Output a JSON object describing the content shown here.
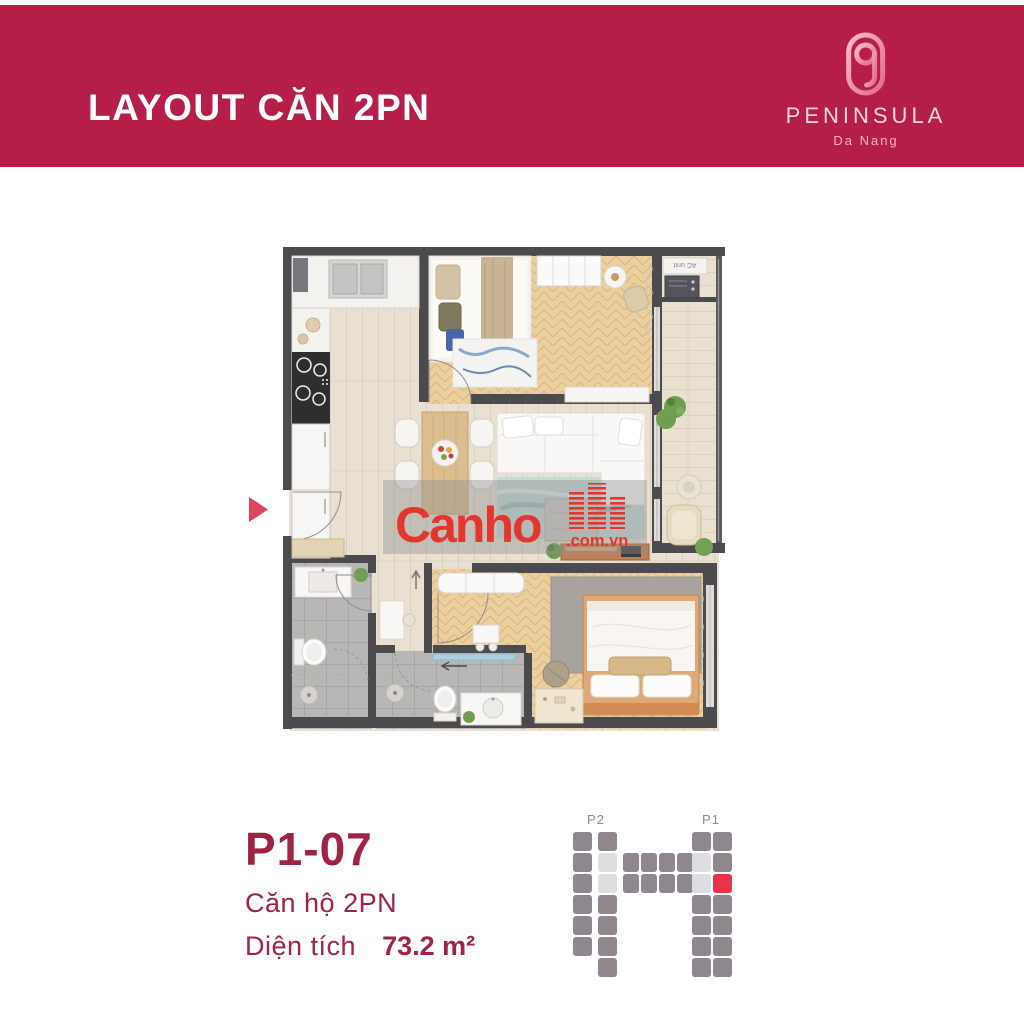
{
  "banner": {
    "title": "LAYOUT CĂN 2PN",
    "brand": "PENINSULA",
    "brand_sub": "Da Nang",
    "bg_color": "#B51F47"
  },
  "unit_info": {
    "code": "P1-07",
    "type_label": "Căn hộ 2PN",
    "area_label": "Diện tích",
    "area_value": "73.2 m²",
    "text_color": "#A02343"
  },
  "watermark": {
    "name": "Canho",
    "domain": ".com.vn",
    "color": "#E3372E"
  },
  "floorplan": {
    "ac_unit_label": "AC unit",
    "wall_color": "#4B4A4C",
    "entry_marker_color": "#DC4560",
    "floor_wood_color": "#E9E0D2",
    "floor_herringbone_color": "#ECCF9F",
    "floor_tile_color": "#B8B7B5"
  },
  "site_diagram": {
    "labels": [
      {
        "text": "P2",
        "x": 23
      },
      {
        "text": "P1",
        "x": 138
      }
    ],
    "colors": {
      "block": "#8E888E",
      "corridor": "#DEDDE0",
      "highlight": "#E83348",
      "label": "#8E888E"
    },
    "unit": {
      "w": 19,
      "h": 19
    },
    "blocks": [
      {
        "x": 0,
        "y": 24,
        "c": "g"
      },
      {
        "x": 0,
        "y": 45,
        "c": "g"
      },
      {
        "x": 0,
        "y": 66,
        "c": "g"
      },
      {
        "x": 0,
        "y": 87,
        "c": "g"
      },
      {
        "x": 0,
        "y": 108,
        "c": "g"
      },
      {
        "x": 0,
        "y": 129,
        "c": "g"
      },
      {
        "x": 25,
        "y": 24,
        "c": "g"
      },
      {
        "x": 25,
        "y": 45,
        "c": "l"
      },
      {
        "x": 25,
        "y": 66,
        "c": "l"
      },
      {
        "x": 25,
        "y": 87,
        "c": "g"
      },
      {
        "x": 25,
        "y": 108,
        "c": "g"
      },
      {
        "x": 25,
        "y": 129,
        "c": "g"
      },
      {
        "x": 25,
        "y": 150,
        "c": "g"
      },
      {
        "x": 50,
        "y": 45,
        "c": "g",
        "w": 16
      },
      {
        "x": 68,
        "y": 45,
        "c": "g",
        "w": 16
      },
      {
        "x": 86,
        "y": 45,
        "c": "g",
        "w": 16
      },
      {
        "x": 104,
        "y": 45,
        "c": "g",
        "w": 16
      },
      {
        "x": 50,
        "y": 66,
        "c": "g",
        "w": 16
      },
      {
        "x": 68,
        "y": 66,
        "c": "g",
        "w": 16
      },
      {
        "x": 86,
        "y": 66,
        "c": "g",
        "w": 16
      },
      {
        "x": 104,
        "y": 66,
        "c": "g",
        "w": 16
      },
      {
        "x": 119,
        "y": 24,
        "c": "g"
      },
      {
        "x": 119,
        "y": 45,
        "c": "l"
      },
      {
        "x": 119,
        "y": 66,
        "c": "l"
      },
      {
        "x": 119,
        "y": 87,
        "c": "g"
      },
      {
        "x": 119,
        "y": 108,
        "c": "g"
      },
      {
        "x": 119,
        "y": 129,
        "c": "g"
      },
      {
        "x": 119,
        "y": 150,
        "c": "g"
      },
      {
        "x": 140,
        "y": 24,
        "c": "g"
      },
      {
        "x": 140,
        "y": 45,
        "c": "g"
      },
      {
        "x": 140,
        "y": 66,
        "c": "r"
      },
      {
        "x": 140,
        "y": 87,
        "c": "g"
      },
      {
        "x": 140,
        "y": 108,
        "c": "g"
      },
      {
        "x": 140,
        "y": 129,
        "c": "g"
      },
      {
        "x": 140,
        "y": 150,
        "c": "g"
      }
    ]
  }
}
